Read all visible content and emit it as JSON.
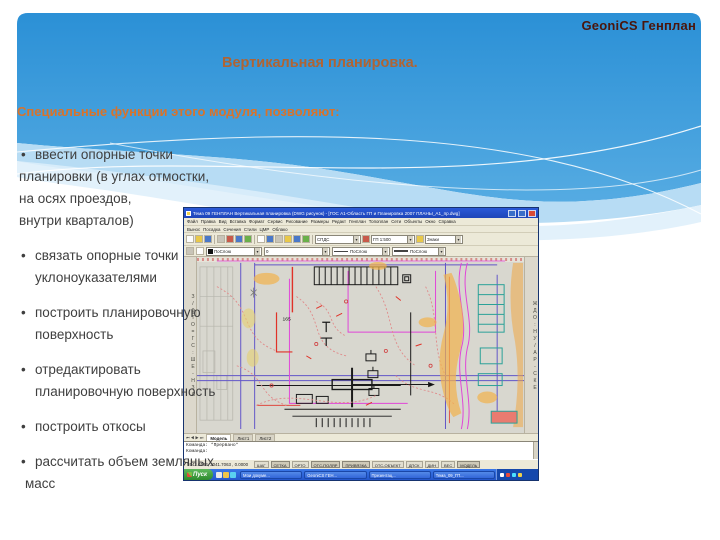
{
  "slide": {
    "brand": "GeoniCS Генплан",
    "title": "Вертикальная планировка.",
    "subtitle": "Специальные функции этого модуля, позволяют:",
    "bullet_dot": "•",
    "bullets": [
      {
        "lines": [
          "ввести опорные точки",
          "планировки (в углах отмостки,",
          "на осях проездов,",
          "внутри кварталов)"
        ]
      },
      {
        "lines": [
          "связать опорные точки",
          "уклоноуказателями"
        ]
      },
      {
        "lines": [
          "построить планировочную",
          "поверхность"
        ]
      },
      {
        "lines": [
          "отредактировать",
          "планировочную  поверхность"
        ]
      },
      {
        "lines": [
          "построить откосы"
        ]
      },
      {
        "lines": [
          "рассчитать объем земляных",
          "масс"
        ]
      }
    ],
    "colors": {
      "header_blue": "#2e95d9",
      "accent_orange": "#d8732b",
      "title_brown": "#b06433",
      "brand_maroon": "#4a150c",
      "body_text": "#3f3f3f"
    }
  },
  "cad": {
    "window_title": "Тема 09 ГЕНПЛАН Вертикальная планировка (DWG рисунок) - [ГОС А1-Область ГП и Планировка 2007 ПЛАНЫ_А1_пр.dwg]",
    "menu_row1": [
      "Файл",
      "Правка",
      "Вид",
      "Вставка",
      "Формат",
      "Сервис",
      "Рисование",
      "Размеры",
      "Редакт",
      "Генплан",
      "Топоплан",
      "Сети",
      "Объекты",
      "Окно",
      "Справка"
    ],
    "menu_row2": [
      "Вынос",
      "Посадка",
      "Сечения",
      "Стили",
      "ЦМР",
      "Облако"
    ],
    "toolbar_combos": [
      "СПДС",
      "ГП 1:500",
      "Знаки"
    ],
    "properties": {
      "color": "ПоСлою",
      "layer": "0",
      "linetype": "ПоСлою",
      "lineweight": "ПоСлою"
    },
    "left_toolbar_glyphs": "З/ФТО=ГС:ШЕ-НЗА",
    "right_toolbar_glyphs": "ЖДО:НУ/АР-СКЕ",
    "drawing_label": "165",
    "layout_tabs": [
      "Модель",
      "Лист1",
      "Лист2"
    ],
    "command_lines": [
      "Команда: *Прервано*",
      "Команда:"
    ],
    "status": {
      "coords": "5542.0184, 2041.7063 , 0.0000",
      "toggles": [
        "ШАГ",
        "СЕТКА",
        "ОРТО",
        "ОТС-ПОЛЯР",
        "ПРИВЯЗКА",
        "ОТС-ОБЪЕКТ",
        "ДПСК",
        "ДИН",
        "ВЕС",
        "МОДЕЛЬ"
      ]
    },
    "taskbar": {
      "start": "Пуск",
      "tasks": [
        "Мои докуме...",
        "GeoniCS ГЕН...",
        "Презентац...",
        "Тема_09_ГП..."
      ]
    }
  }
}
